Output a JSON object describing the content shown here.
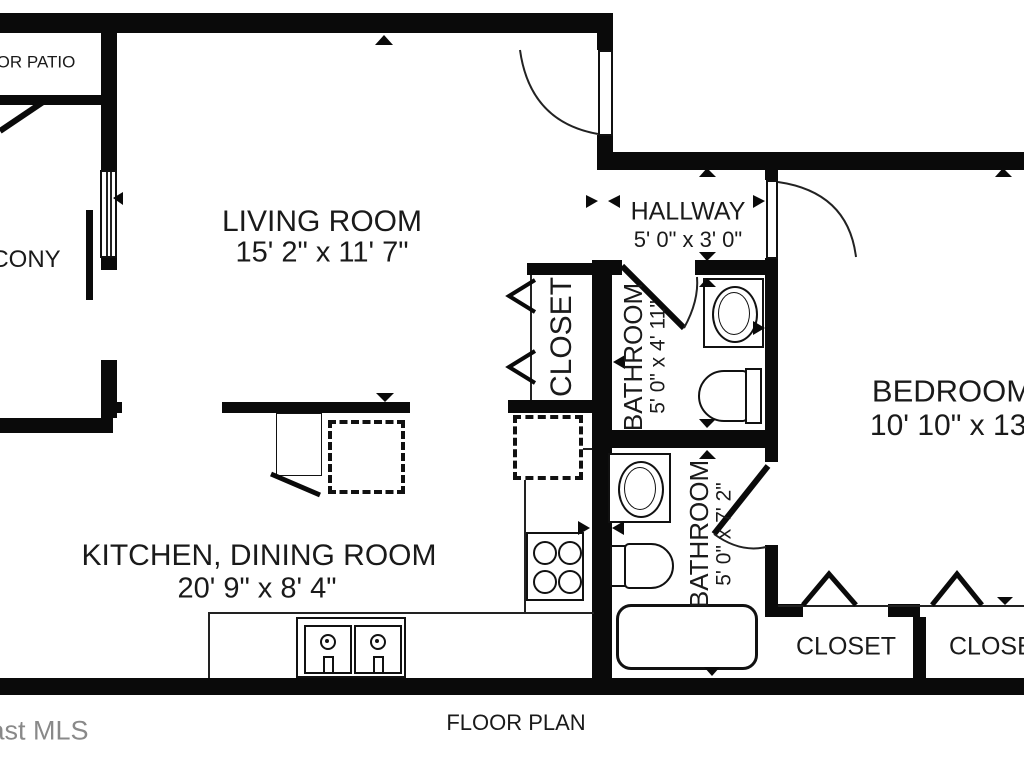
{
  "plan_title": "FLOOR PLAN",
  "watermark": "ast MLS",
  "rooms": {
    "living": {
      "name": "LIVING ROOM",
      "dims": "15' 2\" x 11' 7\""
    },
    "hallway": {
      "name": "HALLWAY",
      "dims": "5' 0\" x 3' 0\""
    },
    "bedroom": {
      "name": "BEDROOM",
      "dims": "10' 10\" x 13'"
    },
    "kitchen": {
      "name": "KITCHEN, DINING ROOM",
      "dims": "20' 9\" x 8' 4\""
    },
    "bathroom_top": {
      "name": "BATHROOM",
      "dims": "5' 0\" x 4' 11\""
    },
    "bathroom_bottom": {
      "name": "BATHROOM",
      "dims": "5' 0\" x 7' 2\""
    },
    "closet_hall": {
      "name": "CLOSET"
    },
    "closet_bedroom_left": {
      "name": "CLOSET"
    },
    "closet_bedroom_right": {
      "name": "CLOSET"
    },
    "balcony": {
      "name": "CONY"
    },
    "patio": {
      "name": "OR PATIO"
    }
  },
  "colors": {
    "wall": "#0a0a0a",
    "background": "#ffffff",
    "text": "#1a1a1a",
    "watermark": "#7d7d7d"
  }
}
